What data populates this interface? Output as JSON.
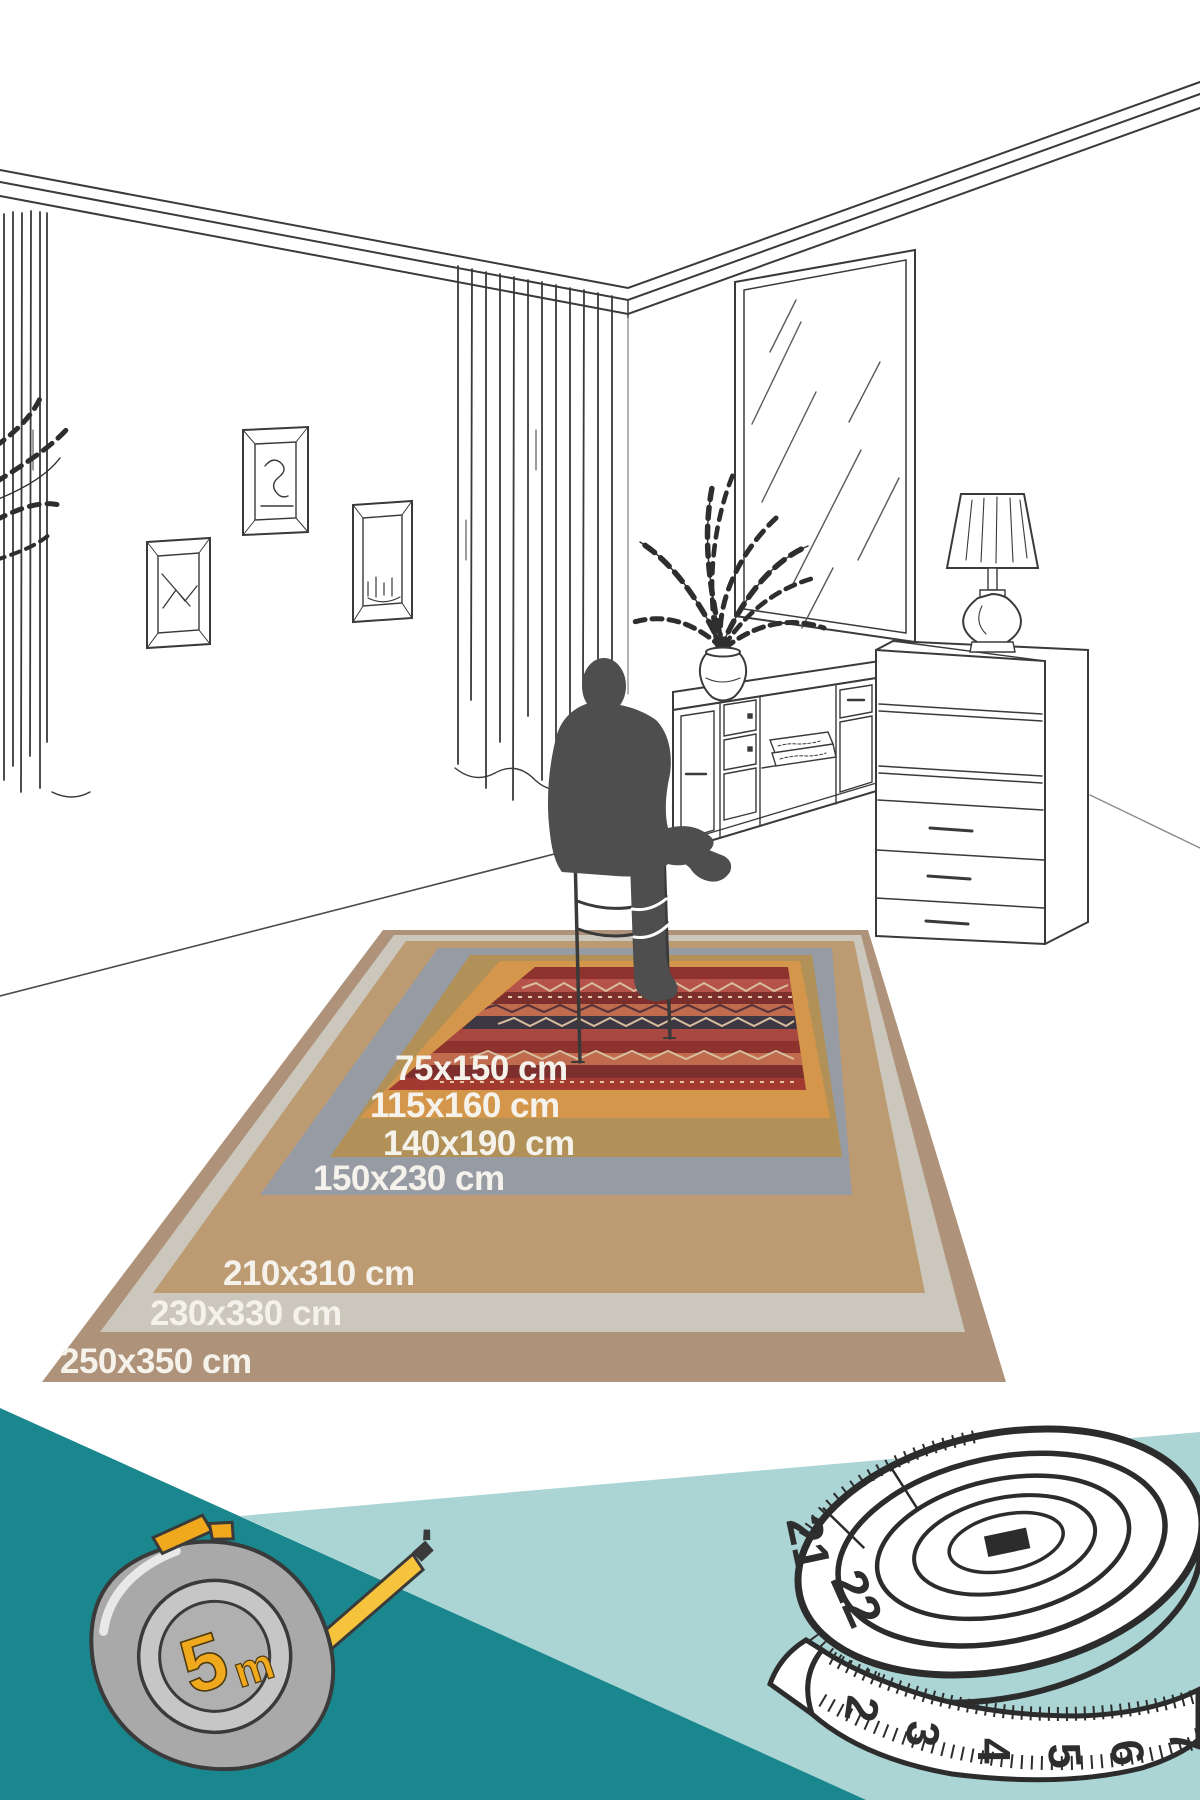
{
  "page": {
    "kind": "rug size comparison infographic",
    "scene": "line-drawn living room with seated person silhouette on nested rugs"
  },
  "rug_sizes": [
    {
      "label": "75x150 cm"
    },
    {
      "label": "115x160 cm"
    },
    {
      "label": "140x190 cm"
    },
    {
      "label": "150x230 cm"
    },
    {
      "label": "210x310 cm"
    },
    {
      "label": "230x330 cm"
    },
    {
      "label": "250x350 cm"
    }
  ],
  "tape_measure": {
    "capacity_number": "5",
    "capacity_unit": "m"
  },
  "sewing_tape": {
    "side_numbers": [
      "21",
      "22"
    ],
    "front_numbers": [
      "2",
      "3",
      "4",
      "5",
      "6",
      "7"
    ]
  },
  "colors": {
    "teal_dark": "#1a878e",
    "teal_light": "#abd5d5",
    "ring_250": "#ae9279",
    "ring_230": "#cbc7bc",
    "ring_210": "#bd9b72",
    "ring_150": "#979ba4",
    "ring_140": "#b19157",
    "ring_115": "#d4964a",
    "rug_red": "#a23a32",
    "silhouette": "#4e4e4e",
    "line_art": "#3a3a3a",
    "tape_yellow": "#f0a81c",
    "label_text": "#f5f2ec"
  }
}
